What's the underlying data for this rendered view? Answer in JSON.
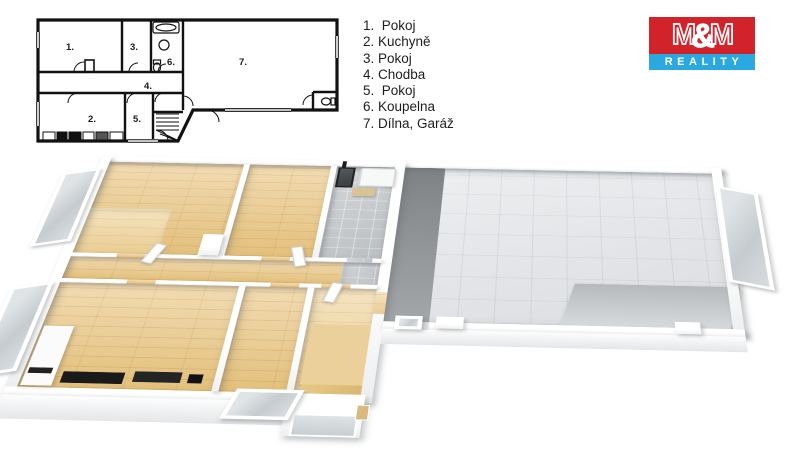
{
  "legend": {
    "items": [
      "1.  Pokoj",
      "2. Kuchyně",
      "3. Pokoj",
      "4. Chodba",
      "5.  Pokoj",
      "6. Koupelna",
      "7. Dílna, Garáž"
    ]
  },
  "logo": {
    "name_parts": [
      "M",
      "&",
      "M"
    ],
    "tagline": "REALITY",
    "colors": {
      "red": "#d2232a",
      "blue": "#29a9e0",
      "text": "#ffffff"
    }
  },
  "floorplan_2d": {
    "room_labels": [
      "1.",
      "2.",
      "3.",
      "4.",
      "5.",
      "6.",
      "7."
    ]
  },
  "floorplan_3d": {
    "floor_colors": {
      "wood": "#ebce98",
      "bath_tile": "#c9cccf",
      "garage": "#e5e7e9",
      "garage_dark": "#7e8184",
      "stairs": "#ecd09c",
      "walls": "#ffffff"
    }
  }
}
